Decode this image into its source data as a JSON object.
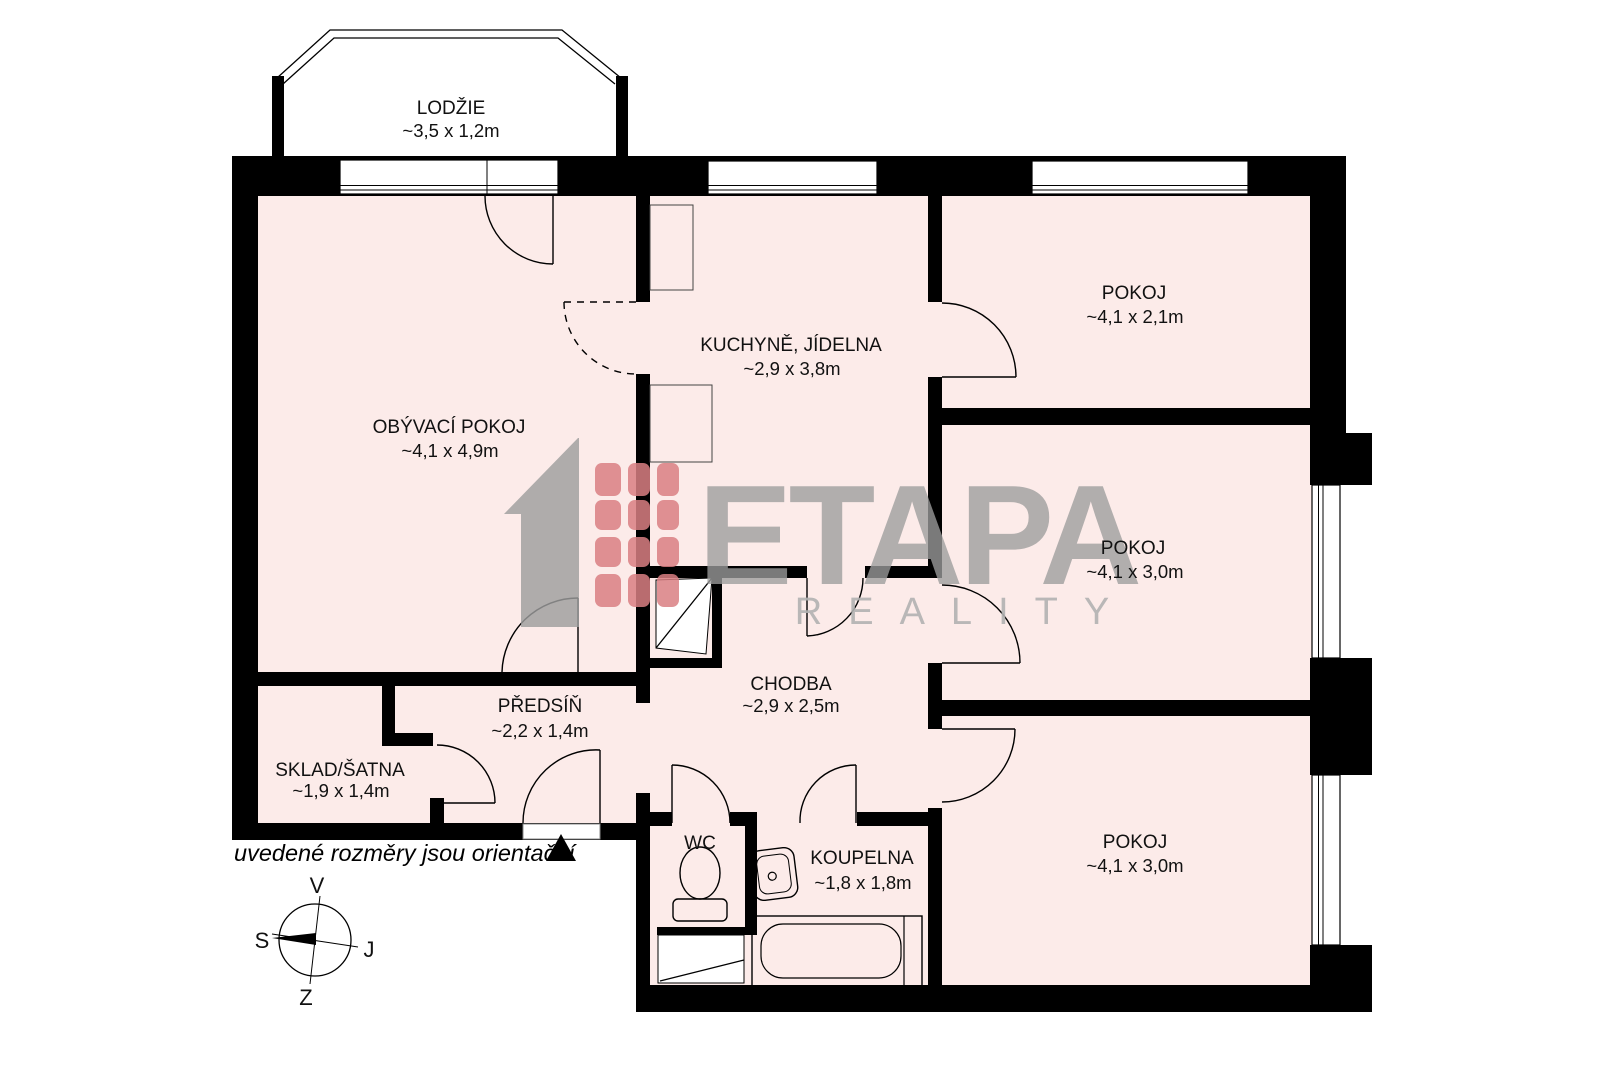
{
  "floorplan": {
    "rooms": [
      {
        "name": "LODŽIE",
        "dims": "~3,5 x 1,2m"
      },
      {
        "name": "OBÝVACÍ POKOJ",
        "dims": "~4,1 x 4,9m"
      },
      {
        "name": "KUCHYNĚ, JÍDELNA",
        "dims": "~2,9 x 3,8m"
      },
      {
        "name": "POKOJ",
        "dims": "~4,1 x 2,1m"
      },
      {
        "name": "POKOJ",
        "dims": "~4,1 x 3,0m"
      },
      {
        "name": "POKOJ",
        "dims": "~4,1 x 3,0m"
      },
      {
        "name": "CHODBA",
        "dims": "~2,9 x 2,5m"
      },
      {
        "name": "PŘEDSÍŇ",
        "dims": "~2,2 x 1,4m"
      },
      {
        "name": "SKLAD/ŠATNA",
        "dims": "~1,9 x 1,4m"
      },
      {
        "name": "WC",
        "dims": ""
      },
      {
        "name": "KOUPELNA",
        "dims": "~1,8 x 1,8m"
      }
    ],
    "disclaimer": "uvedené rozměry jsou orientační",
    "compass": {
      "top": "V",
      "right": "J",
      "bottom": "Z",
      "left": "S"
    },
    "watermark": {
      "brand": "ETAPA",
      "subtitle": "REALITY"
    },
    "colors": {
      "room_fill": "#fcebe9",
      "wall": "#000000",
      "watermark_gray": "#9d9d9d",
      "watermark_red": "#d97f83"
    }
  }
}
